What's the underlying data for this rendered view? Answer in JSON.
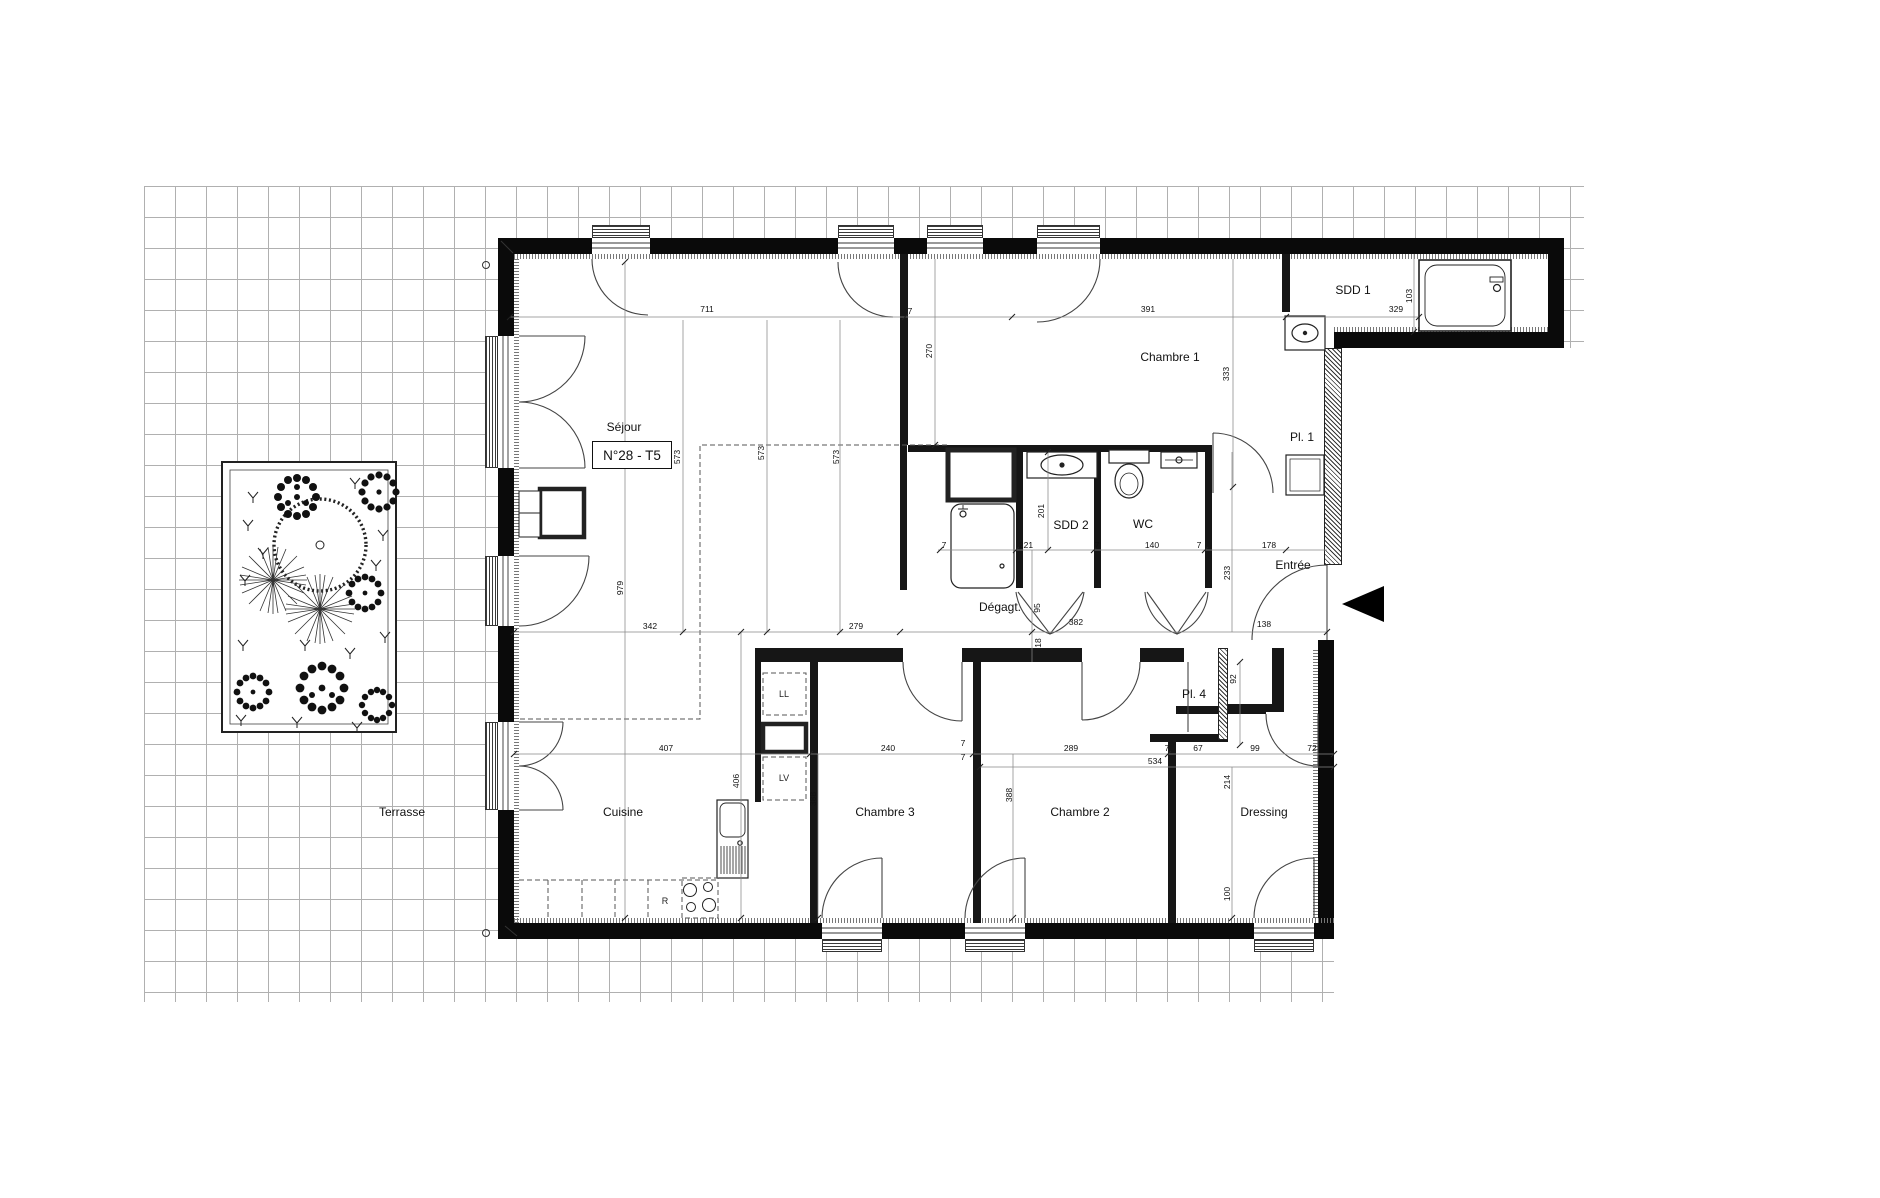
{
  "floorplan": {
    "unit_badge": "N°28 - T5",
    "rooms": {
      "sejour": "Séjour",
      "chambre1": "Chambre 1",
      "sdd1": "SDD 1",
      "pl1": "Pl. 1",
      "sdd2": "SDD 2",
      "wc": "WC",
      "entree": "Entrée",
      "degagt": "Dégagt.",
      "cuisine": "Cuisine",
      "chambre3": "Chambre 3",
      "chambre2": "Chambre 2",
      "dressing": "Dressing",
      "pl4": "Pl. 4",
      "terrasse": "Terrasse"
    },
    "appliances": {
      "washer": "LL",
      "dishwasher": "LV",
      "fridge": "R"
    },
    "dimensions_cm": [
      "711",
      "7",
      "391",
      "329",
      "103",
      "270",
      "333",
      "573",
      "573",
      "573",
      "201",
      "7",
      "221",
      "7",
      "140",
      "7",
      "178",
      "233",
      "342",
      "279",
      "382",
      "95",
      "18",
      "138",
      "92",
      "407",
      "240",
      "7",
      "7",
      "289",
      "7",
      "67",
      "99",
      "72",
      "534",
      "406",
      "214",
      "100",
      "388",
      "388",
      "979"
    ]
  }
}
